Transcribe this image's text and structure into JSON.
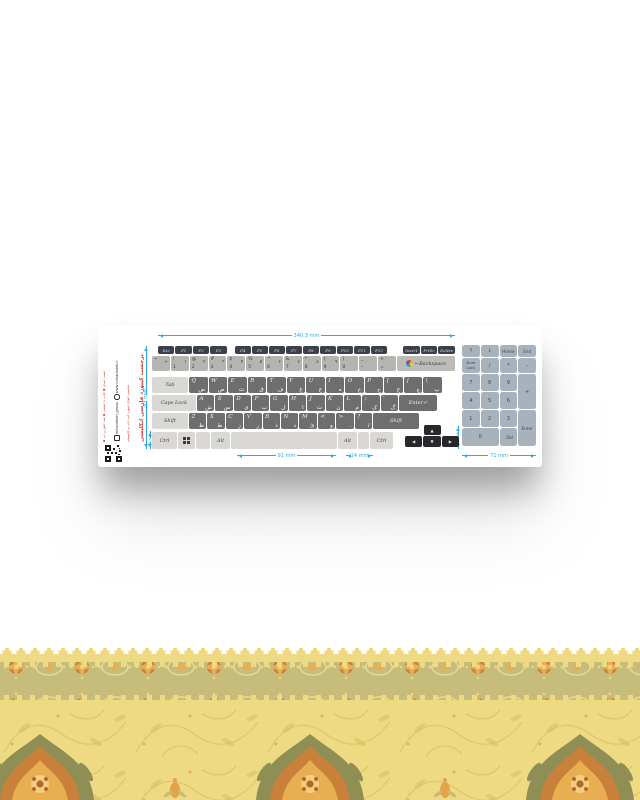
{
  "card": {
    "type": "keyboard-sticker-product-image",
    "brand": {
      "features": "▪ نصب آسان ▪ چاپ با کیفیت ▪ ضد خش و آب",
      "website": "www.mihanlabel.ir",
      "instagram": "mihanlabel_group",
      "note": "مناسب انواع کیبورد لپ تاپ و کامپیوتر",
      "title": "برچسب کیبورد فارسی انگلیسی",
      "qr_icon": "qr-code-icon",
      "logo_icon": "brand-logo-icon",
      "win_icon": "windows-logo-icon"
    },
    "dimensions": {
      "width_total": "340.3 mm",
      "height_total": "93 mm",
      "spacebar": "91 mm",
      "alt_key": "14 mm",
      "numpad_width": "71 mm",
      "arrow_col": "14 mm",
      "row_height": "15 mm"
    },
    "keyboard": {
      "fn_left": [
        "Esc",
        "F1",
        "F2",
        "F3"
      ],
      "fn_mid": [
        "F4",
        "F5",
        "F6",
        "F7",
        "F8",
        "F9",
        "F10",
        "F11",
        "F12"
      ],
      "fn_right": [
        "Insert",
        "PrtSc",
        "Delete"
      ],
      "number_row": [
        {
          "shift": "~",
          "main": "",
          "fa": "÷"
        },
        {
          "shift": "!",
          "main": "1",
          "fa": "۱"
        },
        {
          "shift": "@",
          "main": "2",
          "fa": "۲"
        },
        {
          "shift": "#",
          "main": "3",
          "fa": "۳"
        },
        {
          "shift": "$",
          "main": "4",
          "fa": "۴"
        },
        {
          "shift": "%",
          "main": "5",
          "fa": "۵"
        },
        {
          "shift": "^",
          "main": "6",
          "fa": "۶"
        },
        {
          "shift": "&",
          "main": "7",
          "fa": "۷"
        },
        {
          "shift": "*",
          "main": "8",
          "fa": "۸"
        },
        {
          "shift": "(",
          "main": "9",
          "fa": "۹"
        },
        {
          "shift": ")",
          "main": "0",
          "fa": "۰"
        },
        {
          "shift": "_",
          "main": "-",
          "fa": ""
        },
        {
          "shift": "+",
          "main": "=",
          "fa": ""
        }
      ],
      "backspace": {
        "arrow": "←",
        "label": "Backspace"
      },
      "row_q": [
        {
          "en": "Q",
          "fa": "ض"
        },
        {
          "en": "W",
          "fa": "ص"
        },
        {
          "en": "E",
          "fa": "ث"
        },
        {
          "en": "R",
          "fa": "ق"
        },
        {
          "en": "T",
          "fa": "ف"
        },
        {
          "en": "Y",
          "fa": "غ"
        },
        {
          "en": "U",
          "fa": "ع"
        },
        {
          "en": "I",
          "fa": "ه"
        },
        {
          "en": "O",
          "fa": "خ"
        },
        {
          "en": "P",
          "fa": "ح"
        },
        {
          "en": "[",
          "fa": "ج"
        },
        {
          "en": "]",
          "fa": "چ"
        },
        {
          "en": "\\",
          "fa": "پ"
        }
      ],
      "row_a": [
        {
          "en": "A",
          "fa": "ش"
        },
        {
          "en": "S",
          "fa": "س"
        },
        {
          "en": "D",
          "fa": "ی"
        },
        {
          "en": "F",
          "fa": "ب"
        },
        {
          "en": "G",
          "fa": "ل"
        },
        {
          "en": "H",
          "fa": "ا"
        },
        {
          "en": "J",
          "fa": "ت"
        },
        {
          "en": "K",
          "fa": "ن"
        },
        {
          "en": "L",
          "fa": "م"
        },
        {
          "en": ";",
          "fa": "ک"
        },
        {
          "en": "'",
          "fa": "گ"
        }
      ],
      "row_z": [
        {
          "en": "Z",
          "fa": "ظ"
        },
        {
          "en": "X",
          "fa": "ط"
        },
        {
          "en": "C",
          "fa": "ز"
        },
        {
          "en": "V",
          "fa": "ر"
        },
        {
          "en": "B",
          "fa": "ذ"
        },
        {
          "en": "N",
          "fa": "د"
        },
        {
          "en": "M",
          "fa": "ئ"
        },
        {
          "en": "<",
          "fa": "و"
        },
        {
          "en": ">",
          "fa": "."
        },
        {
          "en": "?",
          "fa": "/"
        }
      ],
      "modifiers": {
        "tab": "Tab",
        "caps": "Caps Lock",
        "shift": "Shift",
        "enter": "Enter",
        "enter_arrow": "↵",
        "ctrl": "Ctrl",
        "alt": "Alt"
      },
      "arrows": {
        "up": "▲",
        "left": "◀",
        "down": "▼",
        "right": "▶"
      },
      "numpad": [
        "↑",
        "↓",
        "Home",
        "End",
        "Num Lock",
        "/",
        "*",
        "-",
        "7",
        "8",
        "9",
        "+",
        "4",
        "5",
        "6",
        "1",
        "2",
        "3",
        "Enter",
        "0",
        ". Del"
      ]
    },
    "colors": {
      "dim_line": "#2faae0",
      "key_dark": "#3b404c",
      "key_letter": "#6f6d6e",
      "key_light": "#d9d8d5",
      "key_number": "#b6b4b1",
      "key_numpad": "#a7b2bd",
      "arrow_keys": "#28282c",
      "brand_red": "#d6403c"
    }
  },
  "ornament": {
    "base": "#eeda83",
    "band": "#c6bd7c",
    "flower": "#e8ae52",
    "flower_deep": "#c9803a",
    "olive": "#8f8f55",
    "scroll": "#dcc164"
  }
}
